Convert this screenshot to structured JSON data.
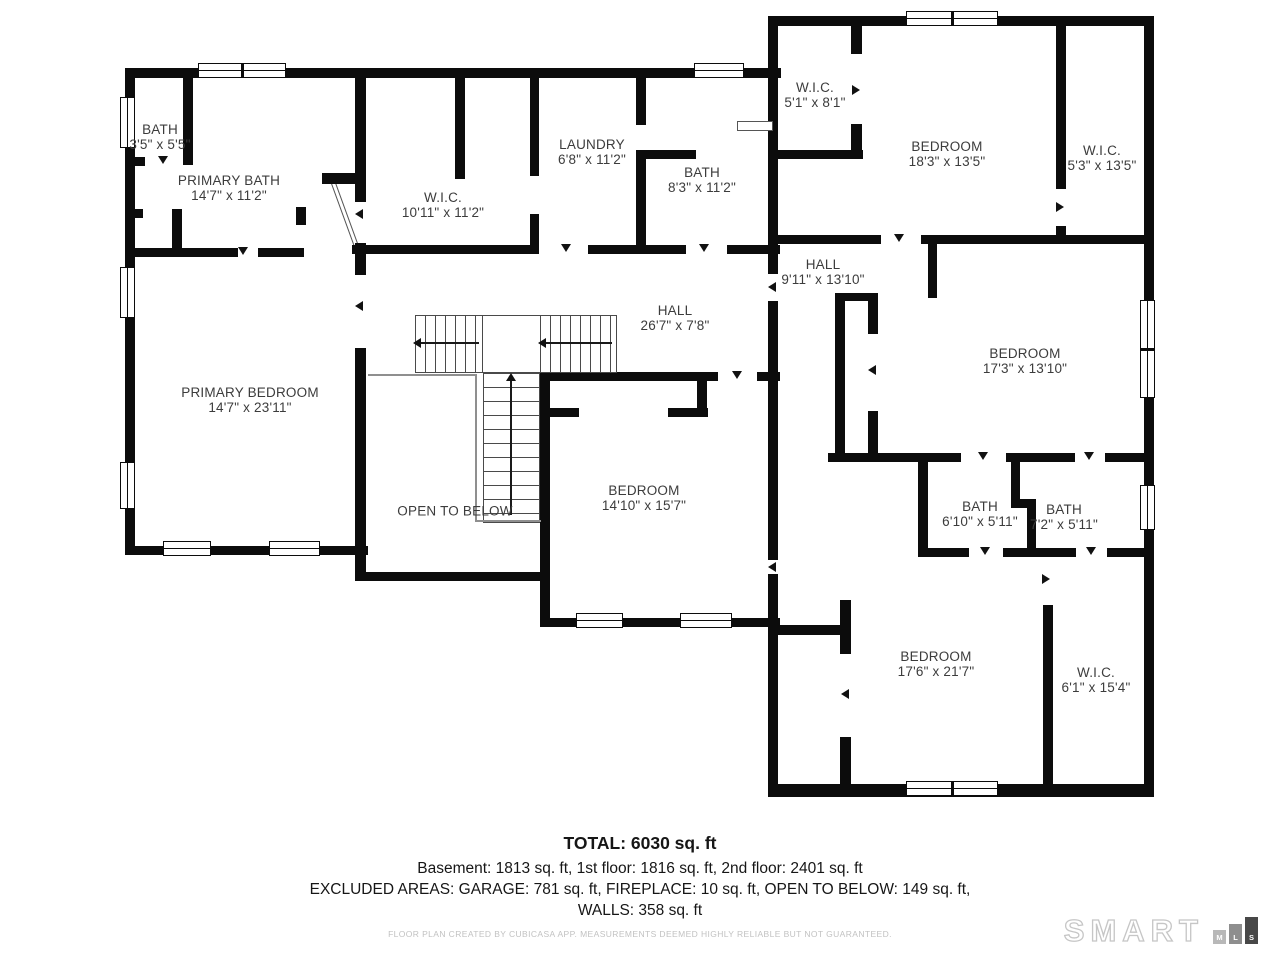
{
  "plan": {
    "rooms": [
      {
        "id": "bath-upper-left",
        "label": "BATH",
        "dims": "3'5\" x 5'5\"",
        "cx": 160,
        "cy": 137
      },
      {
        "id": "primary-bath",
        "label": "PRIMARY BATH",
        "dims": "14'7\" x 11'2\"",
        "cx": 229,
        "cy": 188
      },
      {
        "id": "wic-primary",
        "label": "W.I.C.",
        "dims": "10'11\" x 11'2\"",
        "cx": 443,
        "cy": 205
      },
      {
        "id": "laundry",
        "label": "LAUNDRY",
        "dims": "6'8\" x 11'2\"",
        "cx": 592,
        "cy": 152
      },
      {
        "id": "bath-hall-upper",
        "label": "BATH",
        "dims": "8'3\" x 11'2\"",
        "cx": 702,
        "cy": 180
      },
      {
        "id": "wic-ne-left",
        "label": "W.I.C.",
        "dims": "5'1\" x 8'1\"",
        "cx": 815,
        "cy": 95
      },
      {
        "id": "bedroom-ne",
        "label": "BEDROOM",
        "dims": "18'3\" x 13'5\"",
        "cx": 947,
        "cy": 154
      },
      {
        "id": "wic-ne-right",
        "label": "W.I.C.",
        "dims": "5'3\" x 13'5\"",
        "cx": 1102,
        "cy": 158
      },
      {
        "id": "hall-upper",
        "label": "HALL",
        "dims": "9'11\" x 13'10\"",
        "cx": 823,
        "cy": 272
      },
      {
        "id": "hall-main",
        "label": "HALL",
        "dims": "26'7\" x 7'8\"",
        "cx": 675,
        "cy": 318
      },
      {
        "id": "primary-bedroom",
        "label": "PRIMARY BEDROOM",
        "dims": "14'7\" x 23'11\"",
        "cx": 250,
        "cy": 400
      },
      {
        "id": "bedroom-east",
        "label": "BEDROOM",
        "dims": "17'3\" x 13'10\"",
        "cx": 1025,
        "cy": 361
      },
      {
        "id": "open-to-below",
        "label": "OPEN TO BELOW",
        "dims": "",
        "cx": 455,
        "cy": 511
      },
      {
        "id": "bedroom-center",
        "label": "BEDROOM",
        "dims": "14'10\" x 15'7\"",
        "cx": 644,
        "cy": 498
      },
      {
        "id": "bath-1",
        "label": "BATH",
        "dims": "6'10\" x 5'11\"",
        "cx": 980,
        "cy": 514
      },
      {
        "id": "bath-2",
        "label": "BATH",
        "dims": "7'2\" x 5'11\"",
        "cx": 1064,
        "cy": 517
      },
      {
        "id": "bedroom-south",
        "label": "BEDROOM",
        "dims": "17'6\" x 21'7\"",
        "cx": 936,
        "cy": 664
      },
      {
        "id": "wic-south",
        "label": "W.I.C.",
        "dims": "6'1\" x 15'4\"",
        "cx": 1096,
        "cy": 680
      }
    ]
  },
  "summary": {
    "total": "TOTAL: 6030 sq. ft",
    "floors": "Basement: 1813 sq. ft, 1st floor: 1816 sq. ft, 2nd floor: 2401 sq. ft",
    "excluded": "EXCLUDED AREAS: GARAGE: 781 sq. ft, FIREPLACE: 10 sq. ft, OPEN TO BELOW: 149 sq. ft,",
    "walls": "WALLS: 358 sq. ft",
    "disclaimer": "FLOOR PLAN CREATED BY CUBICASA APP. MEASUREMENTS DEEMED HIGHLY RELIABLE BUT NOT GUARANTEED."
  },
  "logo": {
    "brand": "SMART",
    "bars": [
      {
        "letter": "M"
      },
      {
        "letter": "L"
      },
      {
        "letter": "S"
      }
    ]
  },
  "colors": {
    "wall": "#0c0c0c",
    "label_text": "#3c3c3c",
    "disclaimer_text": "#c2c2c2",
    "logo_bar_dark": "#484848"
  }
}
